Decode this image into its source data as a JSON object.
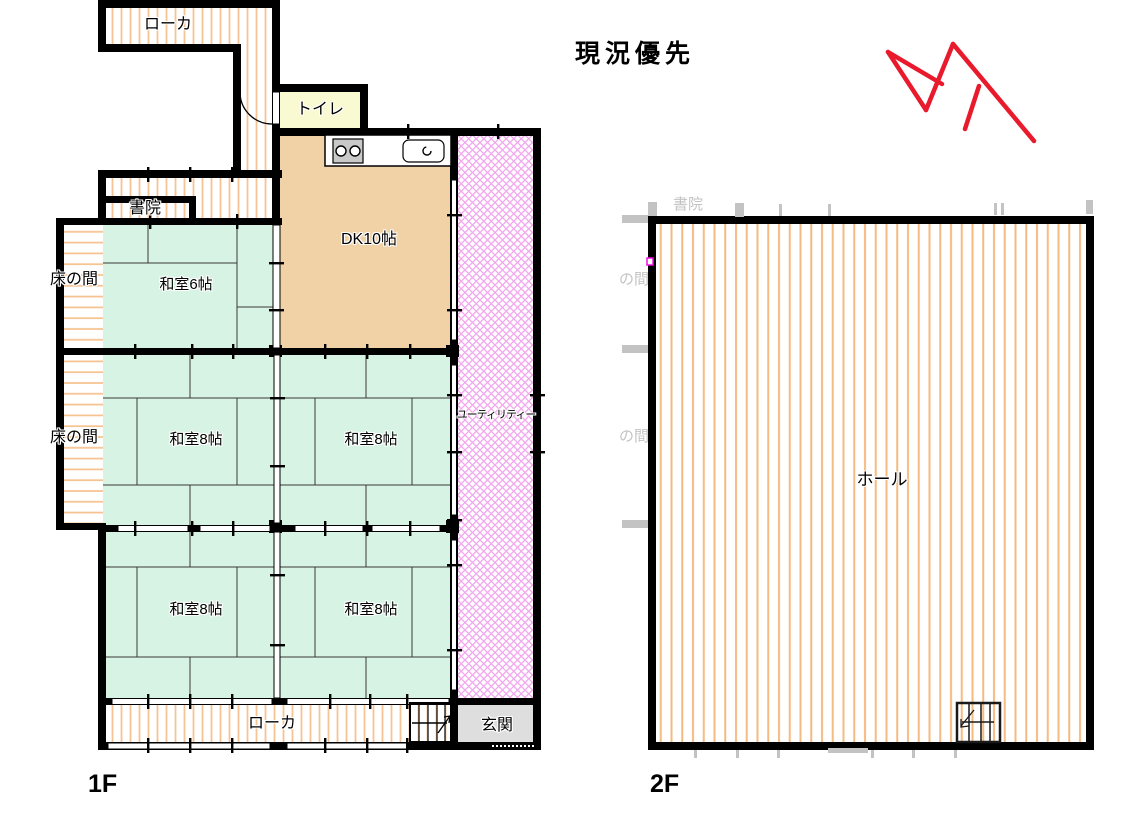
{
  "annotation": {
    "text": "現況優先"
  },
  "floor1": {
    "label": "1F",
    "rooms": {
      "corridor_top": "ローカ",
      "toilet": "トイレ",
      "shoin": "書院",
      "tokonoma_upper": "床の間",
      "tokonoma_lower": "床の間",
      "washitsu6": "和室6帖",
      "dk": "DK10帖",
      "washitsu8_mid_left": "和室8帖",
      "washitsu8_mid_right": "和室8帖",
      "washitsu8_bottom_left": "和室8帖",
      "washitsu8_bottom_right": "和室8帖",
      "utility": "ユーティリティー",
      "genkan": "玄関",
      "corridor_bottom": "ローカ"
    }
  },
  "floor2": {
    "label": "2F",
    "rooms": {
      "hall": "ホール"
    },
    "ghost": {
      "shoin": "書院",
      "noma_upper": "の間",
      "noma_lower": "の間"
    }
  },
  "colors": {
    "wall": "#000000",
    "tatami_green": "#d6f3e3",
    "dk_tan": "#f0d2a6",
    "toilet_yellow": "#fafad2",
    "genkan_gray": "#dedede",
    "stripe_orange": "#f6c493",
    "stripe_orange_2f": "#f5ba80",
    "utility_pink": "#f2a6ee",
    "ghost_gray": "#c3c3c3",
    "red_mark": "#e81a2c"
  }
}
